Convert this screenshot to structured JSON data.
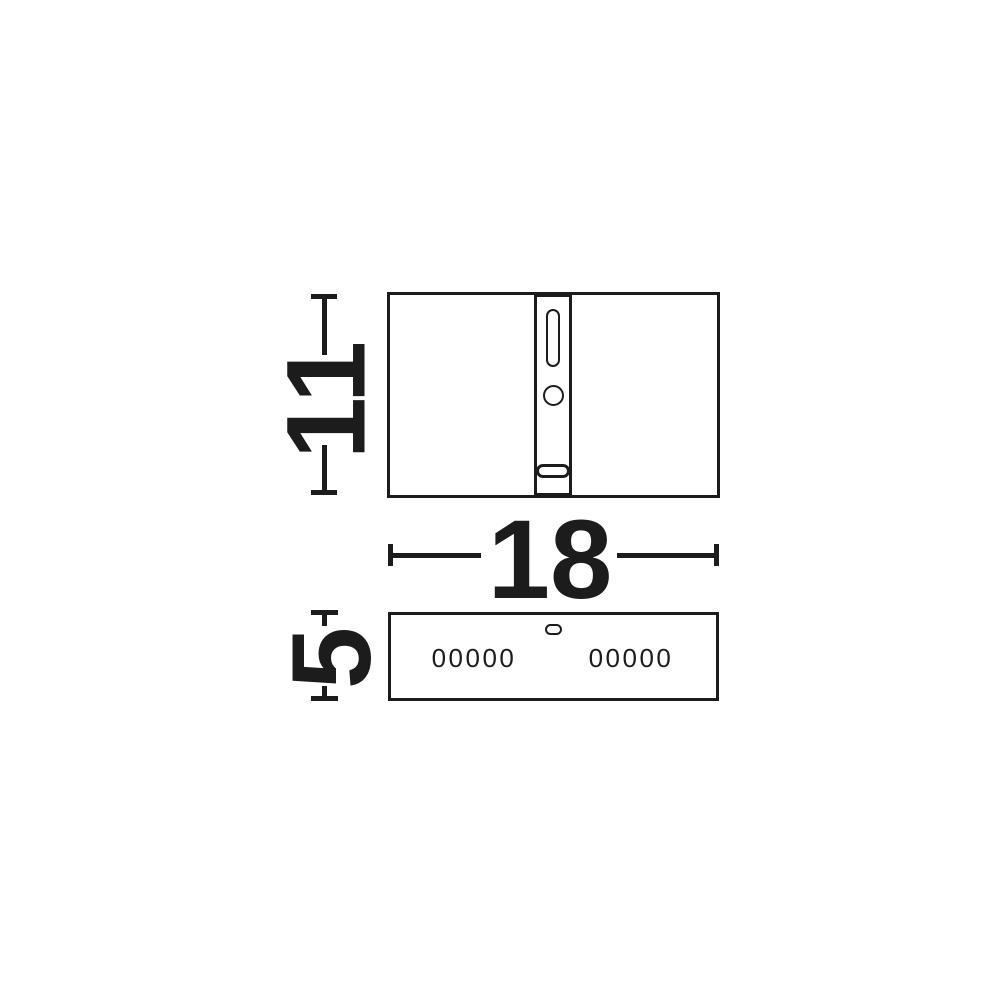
{
  "colors": {
    "ink": "#1c1c1c",
    "background": "#ffffff"
  },
  "diagram": {
    "type": "technical-dimension-drawing",
    "dimensions": {
      "height": {
        "value": "11"
      },
      "width": {
        "value": "18"
      },
      "depth": {
        "value": "5"
      }
    },
    "views": {
      "side": {
        "led_row_left": "00000",
        "led_row_right": "00000"
      }
    }
  }
}
